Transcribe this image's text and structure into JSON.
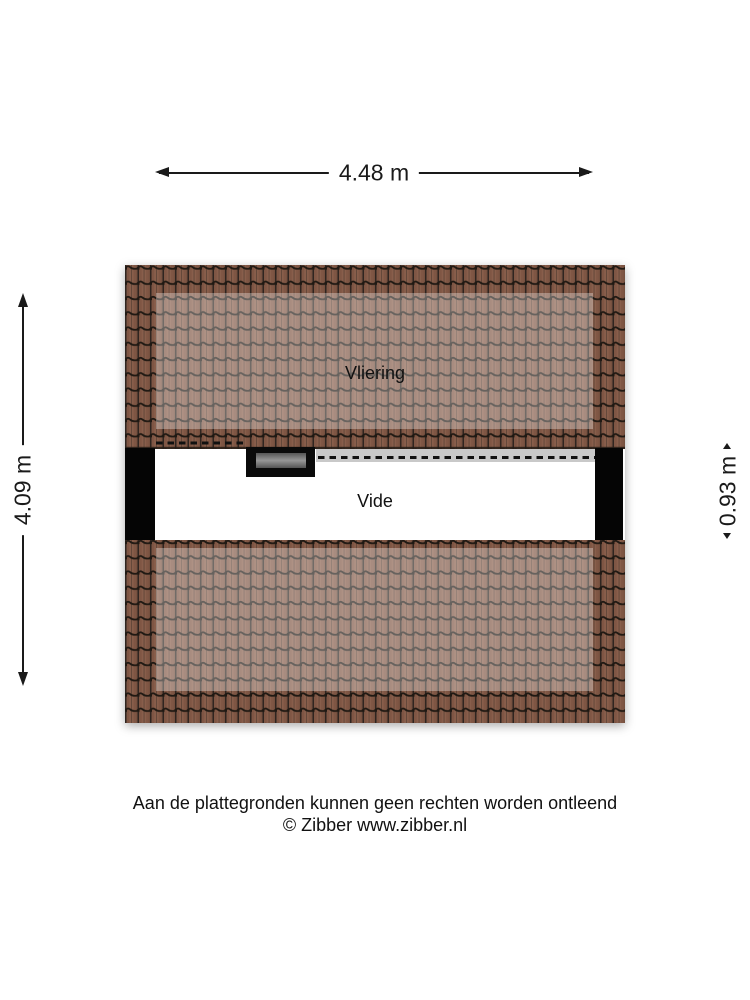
{
  "plan": {
    "rooms": [
      {
        "label": "Vliering"
      },
      {
        "label": "Vide"
      }
    ]
  },
  "dimensions": {
    "width_label": "4.48 m",
    "height_label": "4.09 m",
    "vide_height_label": "0.93 m"
  },
  "footer": {
    "disclaimer": "Aan de plattegronden kunnen geen rechten worden ontleend",
    "copyright": "© Zibber www.zibber.nl"
  },
  "colors": {
    "tile_base": "#75503f",
    "tile_stripe": "#7f5644",
    "tile_stripe_light": "#885e4b",
    "tile_groove": "#2f2520",
    "tile_wave": "#201913",
    "overlay_opacity": "0.32",
    "edge_dark": "#241c16",
    "wall": "#050505",
    "vide_bg": "#ffffff",
    "ledge_gray": "#c9c9c9",
    "dash_line": "#111111",
    "hatch_black": "#0a0a0a",
    "line": "#1a1a1a"
  }
}
